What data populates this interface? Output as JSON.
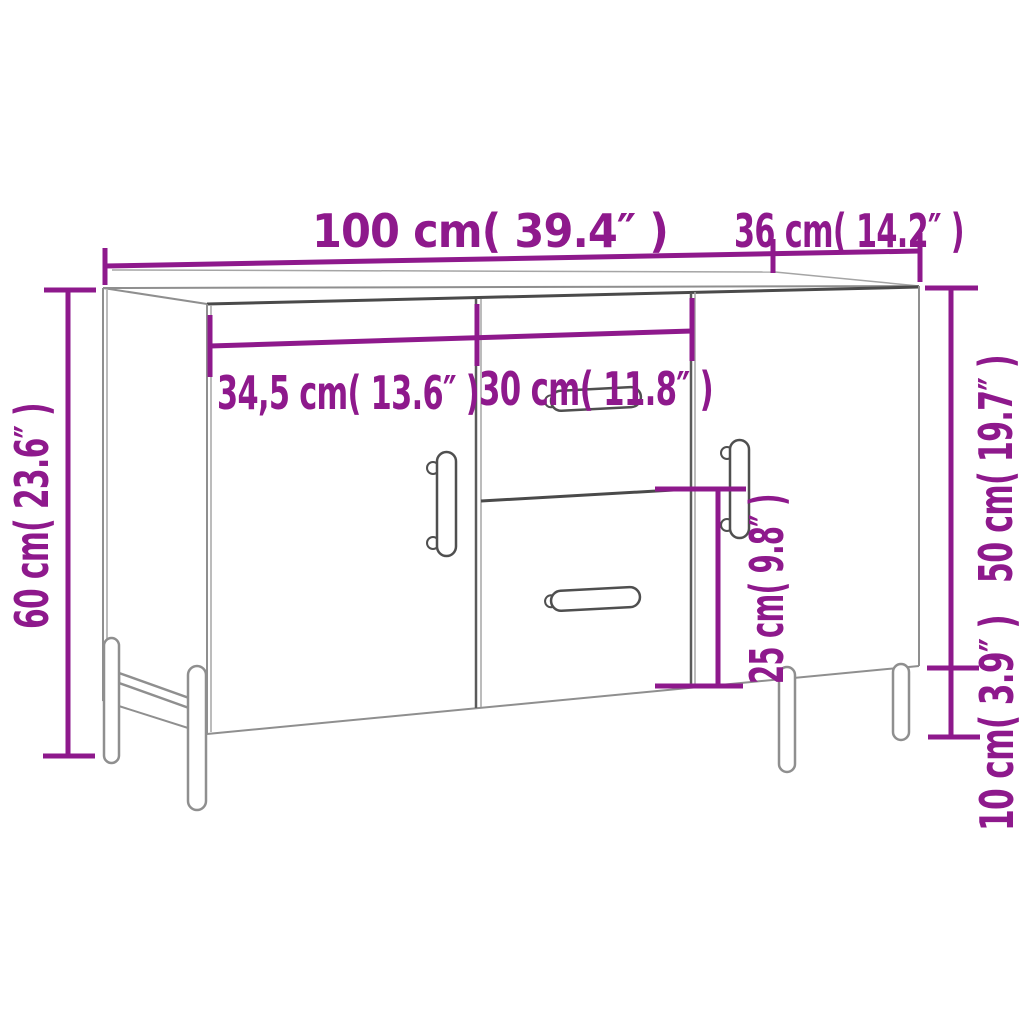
{
  "diagram": {
    "type": "furniture-dimension-diagram",
    "subject": "sideboard with two doors and two drawers, perspective line drawing",
    "accent_color": "#8e198c",
    "outline_color": "#8f8f8f",
    "dark_outline_color": "#4a4a4a",
    "background_color": "#ffffff",
    "labels": {
      "total_width": "100 cm( 39.4″ )",
      "depth": "36 cm( 14.2″ )",
      "left_door_width": "34,5 cm( 13.6″ )",
      "drawer_width": "30 cm( 11.8″ )",
      "total_height": "60 cm( 23.6″ )",
      "body_height": "50 cm( 19.7″ )",
      "leg_height": "10 cm( 3.9″ )",
      "drawer_section_height": "25 cm( 9.8″ )"
    }
  }
}
